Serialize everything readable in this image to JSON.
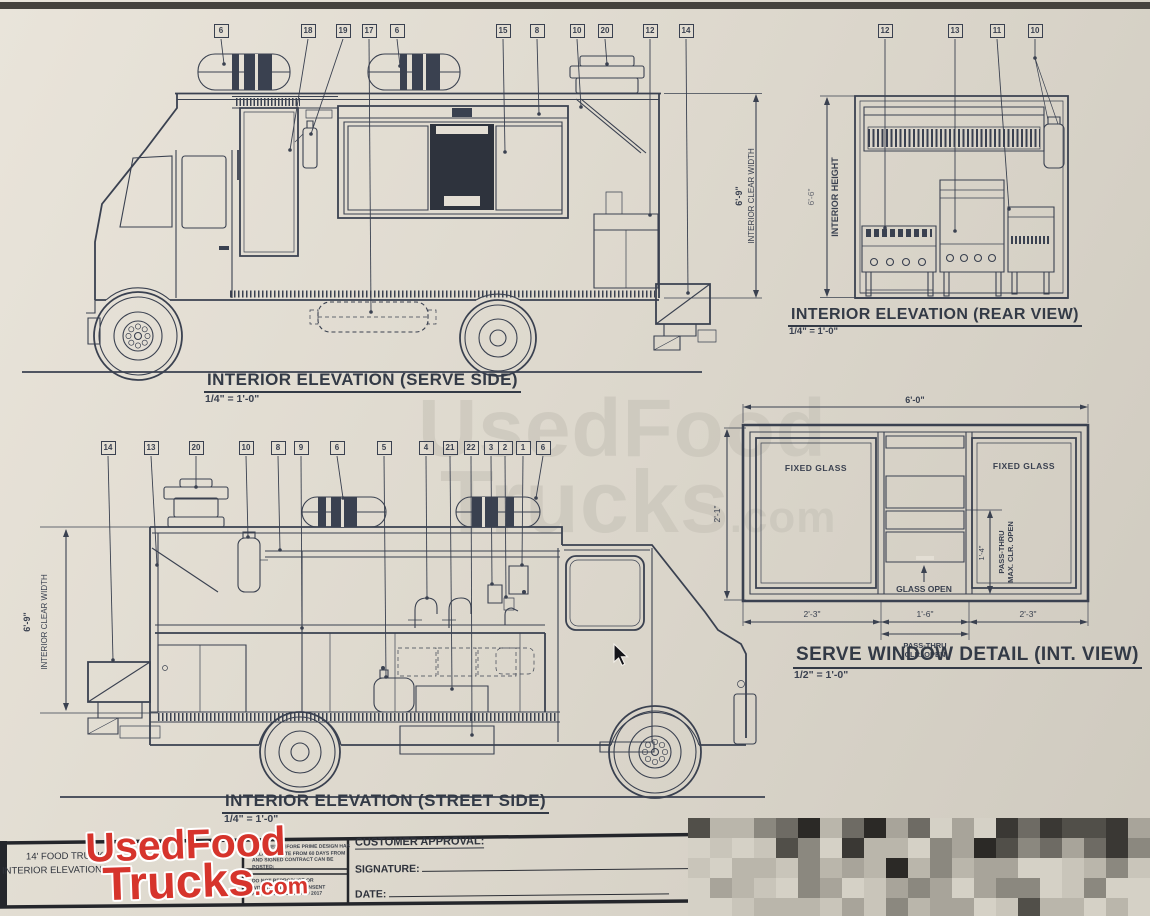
{
  "colors": {
    "paper": "#ded9ce",
    "ink": "#3a4150",
    "logo_red": "#d6342c",
    "watermark": "#c7c3b8"
  },
  "watermark": {
    "line1": "UsedFood",
    "line2": "Trucks",
    "suffix": ".com"
  },
  "views": {
    "serve_side": {
      "title": "INTERIOR ELEVATION (SERVE SIDE)",
      "scale": "1/4\" = 1'-0\"",
      "dim": "6'-9\"",
      "dim_label": "INTERIOR CLEAR WIDTH",
      "callouts": [
        "6",
        "18",
        "19",
        "17",
        "6",
        "15",
        "8",
        "10",
        "20",
        "12",
        "14"
      ]
    },
    "rear_view": {
      "title": "INTERIOR ELEVATION (REAR VIEW)",
      "scale": "1/4\" = 1'-0\"",
      "dim": "6'-6\"",
      "dim_label": "INTERIOR HEIGHT",
      "callouts": [
        "12",
        "13",
        "11",
        "10"
      ]
    },
    "street_side": {
      "title": "INTERIOR ELEVATION (STREET SIDE)",
      "scale": "1/4\" = 1'-0\"",
      "dim": "6'-9\"",
      "dim_label": "INTERIOR CLEAR WIDTH",
      "callouts": [
        "14",
        "13",
        "20",
        "10",
        "8",
        "9",
        "6",
        "5",
        "4",
        "21",
        "22",
        "3",
        "2",
        "1",
        "6"
      ]
    },
    "window_detail": {
      "title": "SERVE WINDOW DETAIL (INT. VIEW)",
      "scale": "1/2\" = 1'-0\"",
      "width_dim": "6'-0\"",
      "height_dim": "2'-1\"",
      "open_height_dim": "1'-4\"",
      "bottom_dims": [
        "2'-3\"",
        "1'-6\"",
        "2'-3\""
      ],
      "left_glass_label": "FIXED GLASS",
      "right_glass_label": "FIXED GLASS",
      "glass_open_label": "GLASS OPEN",
      "pass_thru_bottom": [
        "PASS-THRU",
        "CLR. OPEN"
      ],
      "pass_thru_side": [
        "PASS-THRU",
        "MAX. CLR. OPEN"
      ]
    }
  },
  "title_block": {
    "project_line1": "14' FOOD TRUCK",
    "project_line2": "INTERIOR ELEVATIONS",
    "fine_print_top": [
      "ASSIGNED BEFORE PRIME DESIGN HAS",
      "DELIVERY DATE FROM 60 DAYS FROM",
      "AND SIGNED CONTRACT CAN BE",
      "POSTED:"
    ],
    "fine_print_bottom": [
      "DO NOT REPRODUCE OR",
      "WITHOUT WRITTEN CONSENT",
      "FROM PRIME DESIGN © 2017"
    ],
    "customer_approval_label": "CUSTOMER APPROVAL:",
    "signature_label": "SIGNATURE:",
    "date_label": "DATE:"
  },
  "logo": {
    "line1": "UsedFood",
    "line2": "Trucks",
    "suffix": ".com"
  }
}
